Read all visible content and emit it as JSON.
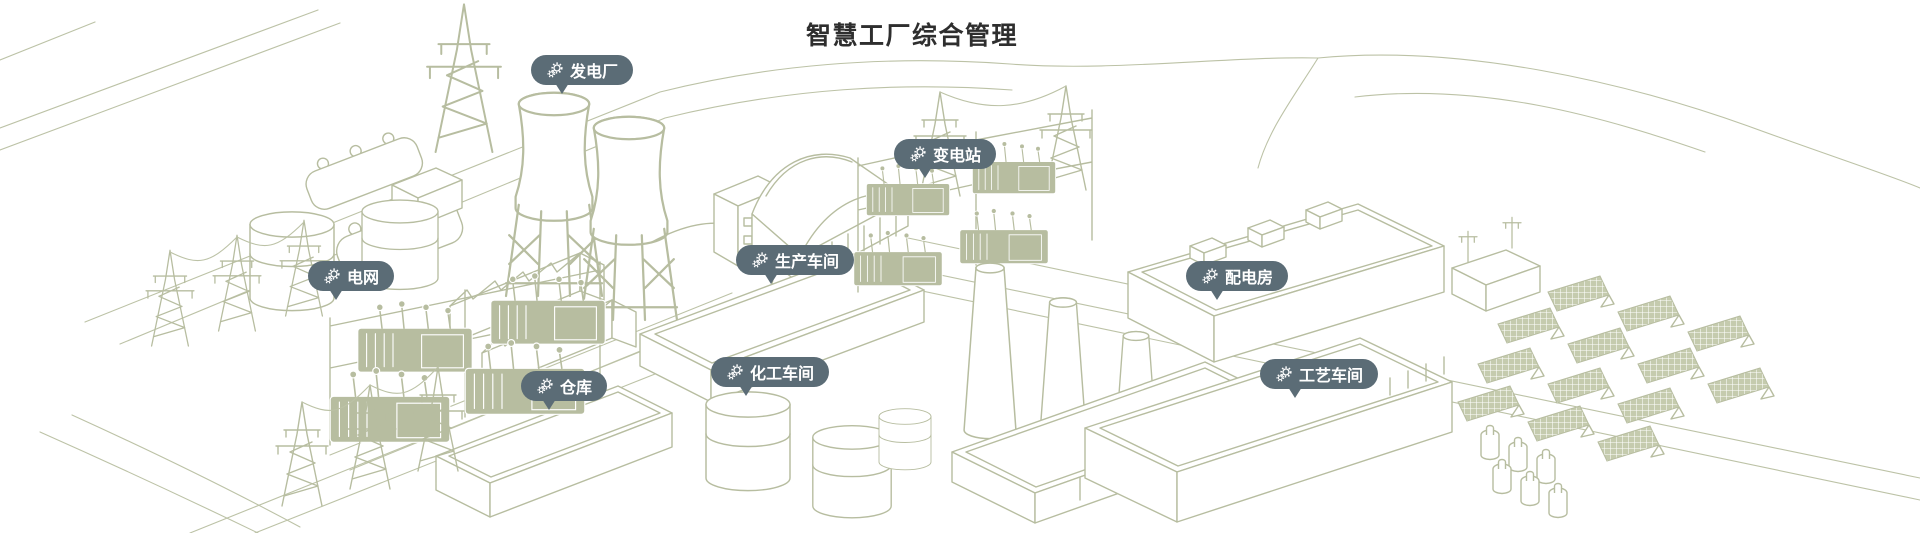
{
  "title": "智慧工厂综合管理",
  "colors": {
    "background": "#ffffff",
    "illustration_line": "#b7bda0",
    "marker_background": "#5b6c76",
    "marker_text": "#ffffff",
    "title_text": "#2e2e2e"
  },
  "markers": [
    {
      "id": "power-plant",
      "label": "发电厂",
      "icon": "gears-icon"
    },
    {
      "id": "substation",
      "label": "变电站",
      "icon": "gears-icon"
    },
    {
      "id": "power-grid",
      "label": "电网",
      "icon": "gears-icon"
    },
    {
      "id": "production-workshop",
      "label": "生产车间",
      "icon": "gears-icon"
    },
    {
      "id": "distribution-room",
      "label": "配电房",
      "icon": "gears-icon"
    },
    {
      "id": "warehouse",
      "label": "仓库",
      "icon": "gears-icon"
    },
    {
      "id": "chemical-workshop",
      "label": "化工车间",
      "icon": "gears-icon"
    },
    {
      "id": "process-workshop",
      "label": "工艺车间",
      "icon": "gears-icon"
    }
  ]
}
